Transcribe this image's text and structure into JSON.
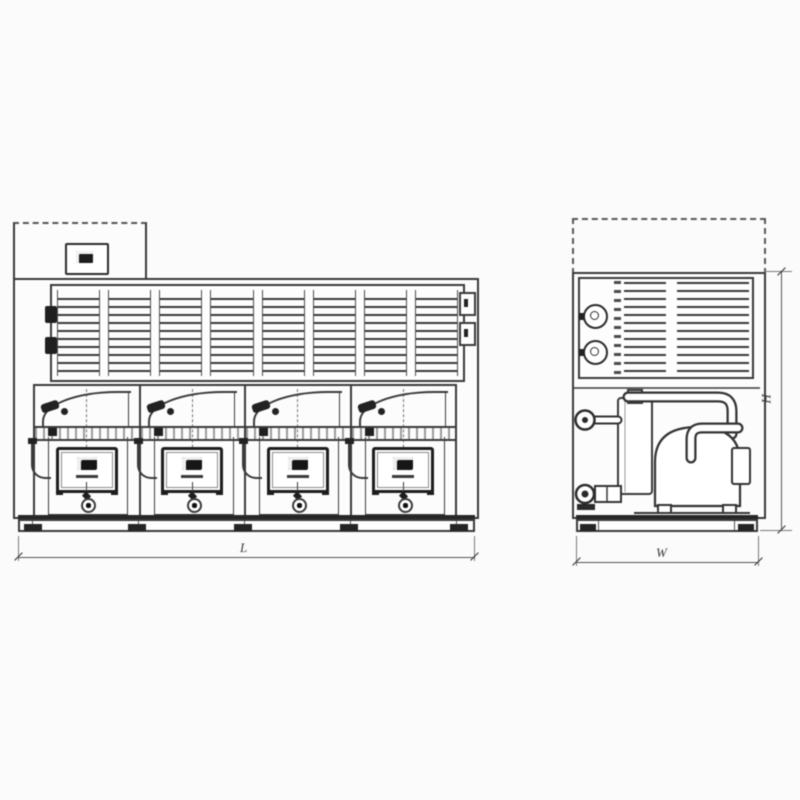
{
  "colors": {
    "background": "#fbfbfb",
    "ink": "#3a3a3a",
    "ink_heavy": "#222222"
  },
  "front_view": {
    "grille": {
      "panel_count": 8
    },
    "modules": {
      "count": 4
    },
    "length_dimension": {
      "label": "L"
    }
  },
  "side_view": {
    "width_dimension": {
      "label": "W"
    },
    "height_dimension": {
      "label": "H"
    }
  }
}
